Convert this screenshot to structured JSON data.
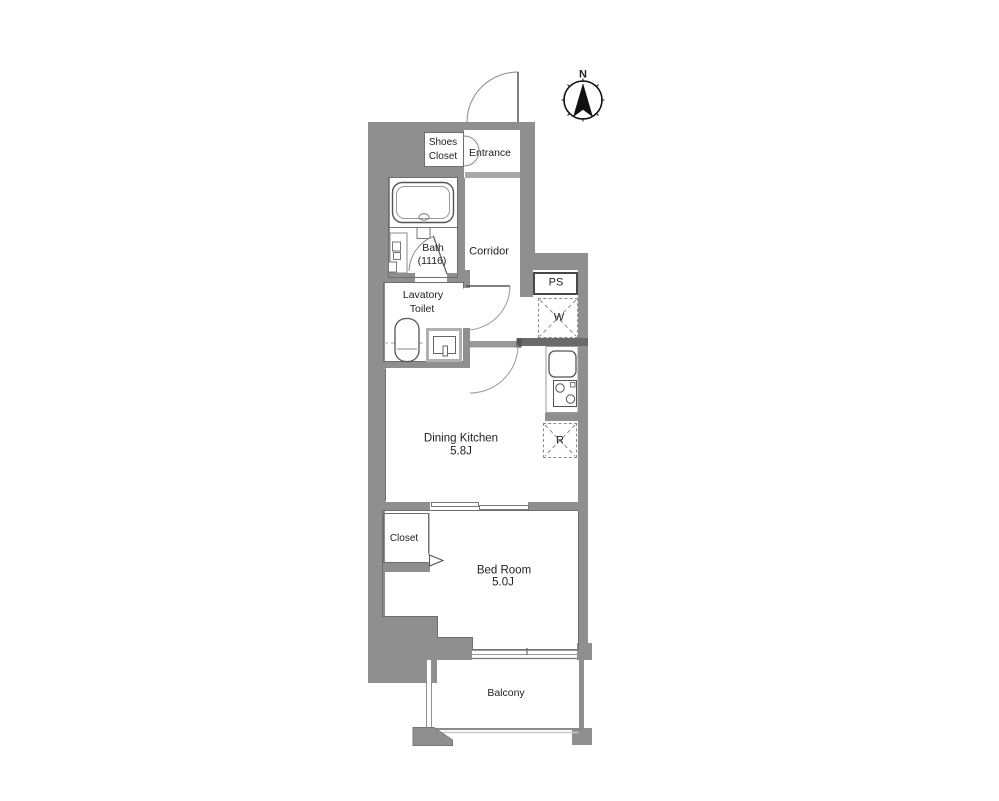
{
  "plan": {
    "type": "apartment-floor-plan",
    "labels": {
      "north": "N",
      "shoes_closet_1": "Shoes",
      "shoes_closet_2": "Closet",
      "entrance": "Entrance",
      "bath_1": "Bath",
      "bath_2": "(1116)",
      "corridor": "Corridor",
      "pipe_space": "PS",
      "washer": "W",
      "lavatory_1": "Lavatory",
      "lavatory_2": "Toilet",
      "dining_kitchen_1": "Dining Kitchen",
      "dining_kitchen_2": "5.8J",
      "refrigerator": "R",
      "closet": "Closet",
      "bedroom_1": "Bed Room",
      "bedroom_2": "5.0J",
      "balcony": "Balcony"
    },
    "fixtures": [
      "bathtub",
      "shower-panel",
      "toilet",
      "vanity-sink",
      "kitchen-sink",
      "gas-stove",
      "washing-machine-space",
      "refrigerator-space",
      "sliding-door",
      "window",
      "north-compass"
    ],
    "colors": {
      "wall": "#8f8f8f",
      "wall_dark": "#6a6a6a",
      "outline": "#6e6e6e",
      "text": "#1f1f1f",
      "background": "#ffffff"
    }
  }
}
